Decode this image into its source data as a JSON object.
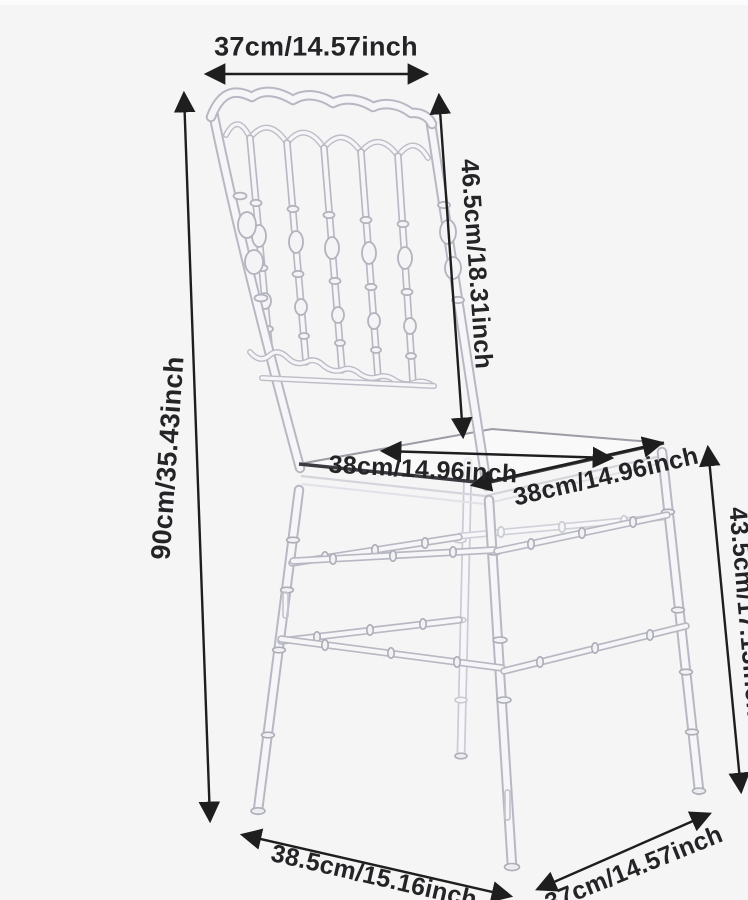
{
  "page": {
    "background_color": "#f5f5f6",
    "annotation_color": "#1e1e1e",
    "illustration": "transparent-resin-napoleon-chiavari-chair"
  },
  "dimensions": {
    "backrest_top_width": {
      "label": "37cm/14.57inch"
    },
    "overall_height": {
      "label": "90cm/35.43inch"
    },
    "backrest_height": {
      "label": "46.5cm/18.31inch"
    },
    "seat_width": {
      "label": "38cm/14.96inch"
    },
    "seat_depth": {
      "label": "38cm/14.96inch"
    },
    "seat_height": {
      "label": "43.5cm/17.13inch"
    },
    "base_depth": {
      "label": "38.5cm/15.16inch"
    },
    "base_width": {
      "label": "37cm/14.57inch"
    }
  }
}
